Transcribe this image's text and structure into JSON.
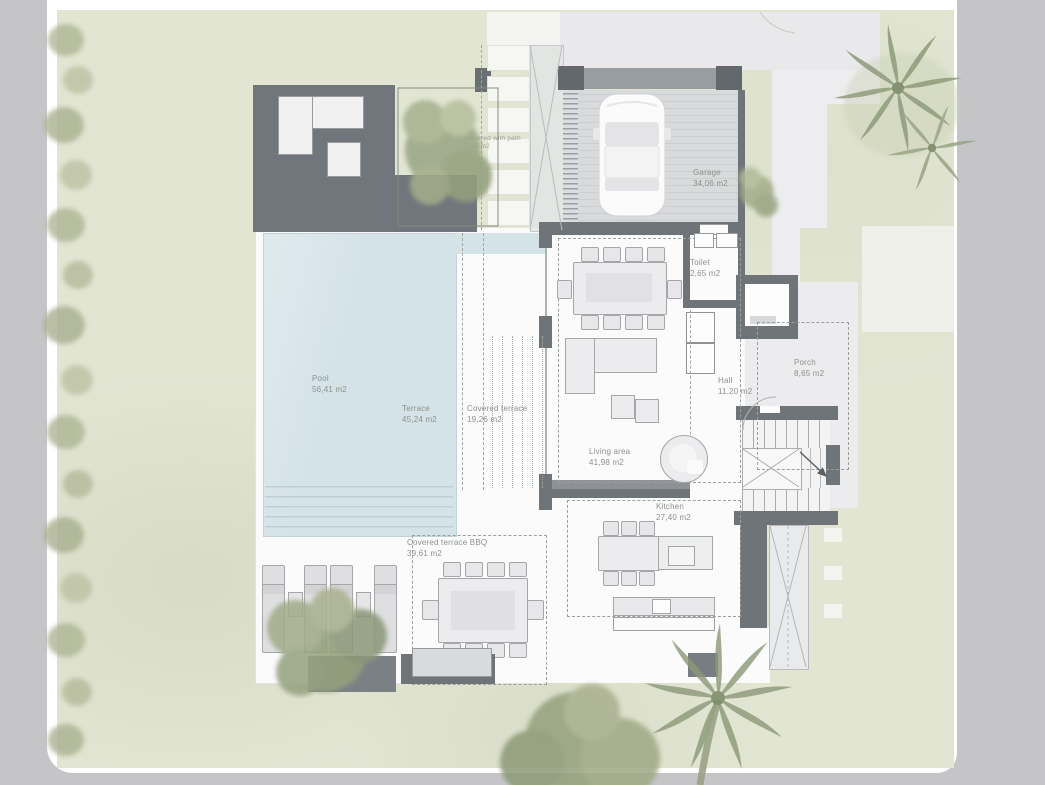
{
  "rooms": {
    "covered_path": {
      "name": "Covered with path",
      "area": "7,16 m2"
    },
    "garage": {
      "name": "Garage",
      "area": "34,06 m2"
    },
    "toilet": {
      "name": "Toilet",
      "area": "2,65 m2"
    },
    "pool": {
      "name": "Pool",
      "area": "56,41 m2"
    },
    "terrace": {
      "name": "Terrace",
      "area": "45,24 m2"
    },
    "covered_terrace": {
      "name": "Covered terrace",
      "area": "19,26 m2"
    },
    "hall": {
      "name": "Hall",
      "area": "11,20 m2"
    },
    "porch": {
      "name": "Porch",
      "area": "8,65 m2"
    },
    "living_area": {
      "name": "Living area",
      "area": "41,98 m2"
    },
    "kitchen": {
      "name": "Kitchen",
      "area": "27,40 m2"
    },
    "covered_terrace_bbq": {
      "name": "Covered terrace BBQ",
      "area": "39,61 m2"
    }
  },
  "colors": {
    "canvas_gray": "#c5c5c7",
    "paper_white": "#ffffff",
    "grass_green": "#e1e5d2",
    "pool_water": "#d4e3e8",
    "deck_gray": "#71767c",
    "wall_gray": "#6f7478",
    "drive_gray": "#ececee",
    "foliage_green": "#9da887",
    "label_text": "#8c918a"
  }
}
